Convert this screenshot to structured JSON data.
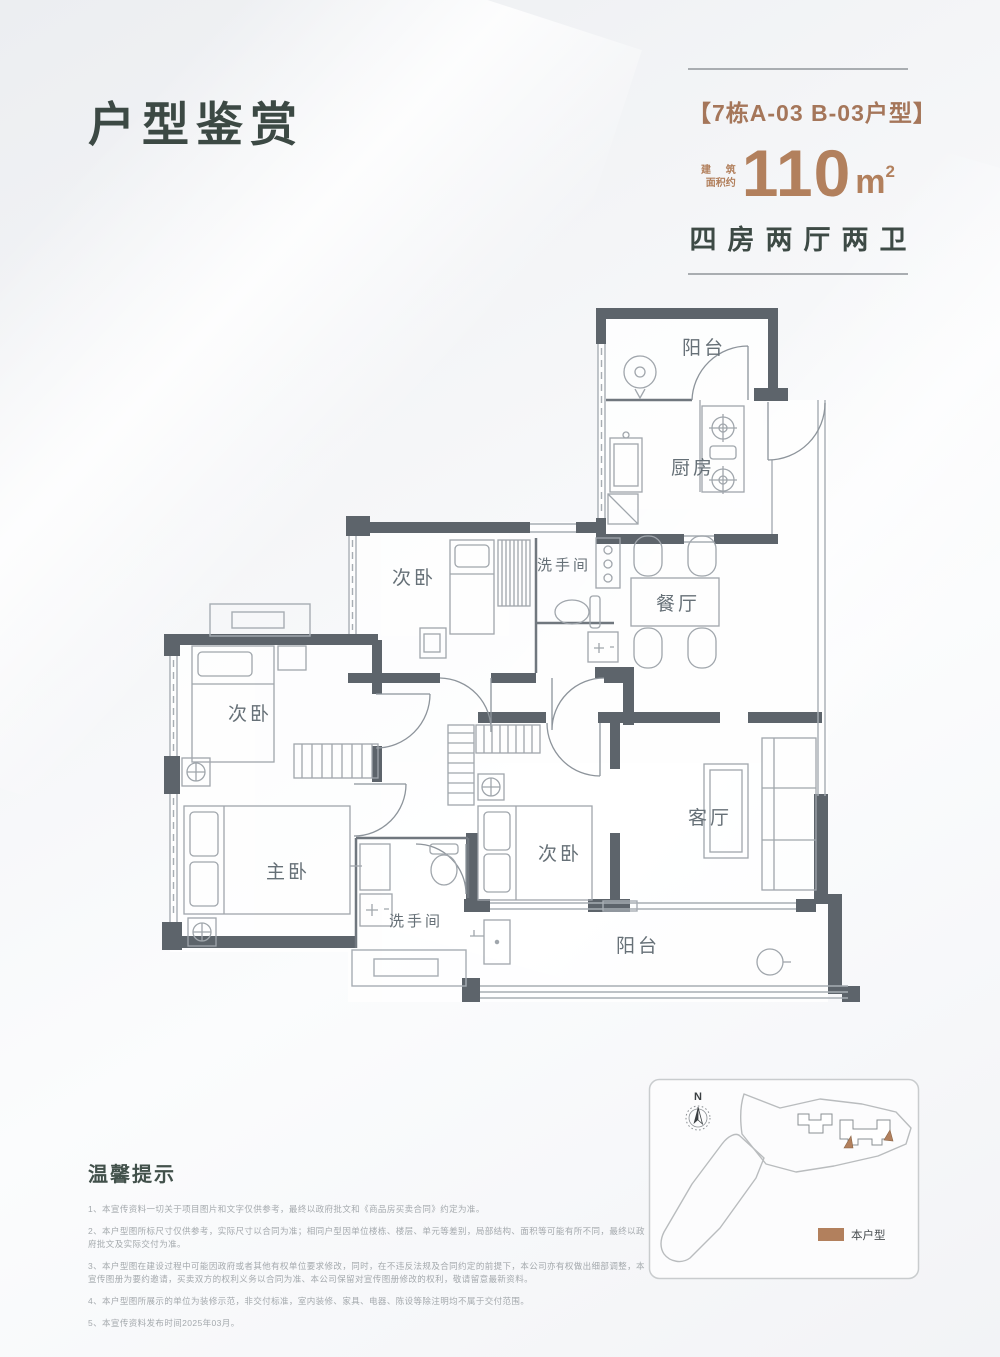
{
  "header": {
    "title": "户型鉴赏",
    "unit_tag": "【7栋A-03  B-03户型】",
    "area_prefix_line1": "建 筑",
    "area_prefix_line2": "面积约",
    "area_value": "110",
    "area_unit_base": "m",
    "area_unit_sup": "2",
    "layout_text": "四房两厅两卫",
    "accent_color": "#b2805d",
    "title_color": "#3c4944"
  },
  "floorplan": {
    "wall_color": "#5d646b",
    "line_color": "#a7adb3",
    "rooms": {
      "balcony_top": "阳台",
      "kitchen": "厨房",
      "bedroom_top": "次卧",
      "bath_top": "洗手间",
      "dining": "餐厅",
      "bedroom_left": "次卧",
      "master": "主卧",
      "bath_bottom": "洗手间",
      "bedroom_mid": "次卧",
      "living": "客厅",
      "balcony_bottom": "阳台"
    }
  },
  "sitemap": {
    "compass_label": "N",
    "legend_label": "本户型",
    "highlight_color": "#b2805d"
  },
  "notes": {
    "heading": "温馨提示",
    "items": [
      "1、本宣传资料一切关于项目图片和文字仅供参考，最终以政府批文和《商品房买卖合同》约定为准。",
      "2、本户型图所标尺寸仅供参考，实际尺寸以合同为准；相同户型因单位楼栋、楼层、单元等差别，局部结构、面积等可能有所不同，最终以政府批文及实际交付为准。",
      "3、本户型图在建设过程中可能因政府或者其他有权单位要求修改，同时，在不违反法规及合同约定的前提下，本公司亦有权做出细部调整，本宣传图册为要约邀请，买卖双方的权利义务以合同为准、本公司保留对宣传图册修改的权利，敬请留意最新资料。",
      "4、本户型图所展示的单位为装修示范，非交付标准，室内装修、家具、电器、陈设等除注明均不属于交付范围。",
      "5、本宣传资料发布时间2025年03月。"
    ]
  }
}
